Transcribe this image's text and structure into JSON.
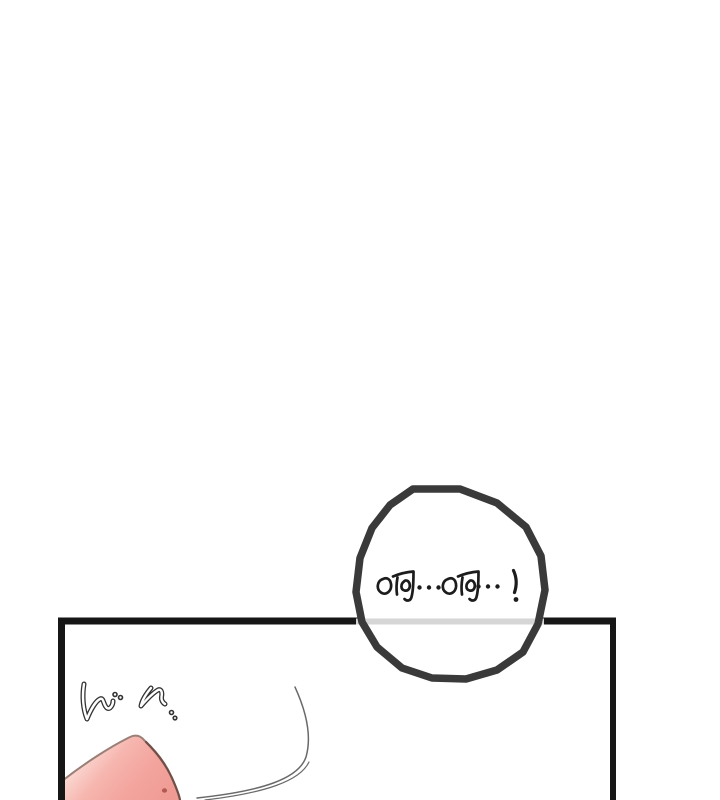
{
  "page": {
    "kind": "webtoon-comic-panel"
  },
  "bubble": {
    "text": "啊...啊...!"
  },
  "colors": {
    "background": "#ffffff",
    "panel_border": "#161616",
    "bubble_stroke": "#3a3a3a",
    "bubble_fill": "#ffffff",
    "panel_line_muted": "#d6d6d6",
    "ink": "#1c1c1c",
    "sfx_outline": "#333333",
    "sfx_core": "#ffffff",
    "skin_highlight": "#fcdcd6",
    "skin_mid": "#f6b6af",
    "skin_main": "#f3a59e",
    "skin_shadow": "#ef9a93",
    "skin_outline": "#9a7f77",
    "skin_outline_dark": "#6b4a42",
    "skin_dot": "#b05a51",
    "motion_line": "#4f4f4f"
  }
}
